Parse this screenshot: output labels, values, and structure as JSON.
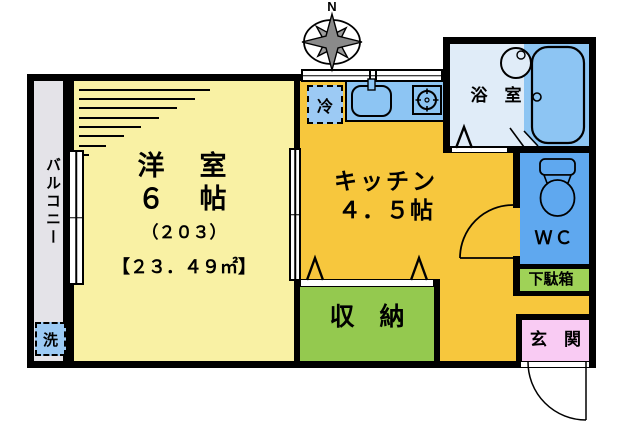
{
  "compass": {
    "north_label": "N"
  },
  "rooms": {
    "balcony": {
      "label": "バルコニー"
    },
    "living": {
      "name": "洋　室",
      "size": "６　帖",
      "unit_no": "（２０３）",
      "area": "【２３．４９㎡】"
    },
    "kitchen": {
      "name": "キッチン",
      "size": "４．５帖"
    },
    "bath": {
      "label": "浴　室"
    },
    "wc": {
      "label": "ＷＣ"
    },
    "shoe_cabinet": {
      "label": "下駄箱"
    },
    "entrance": {
      "label": "玄　関"
    },
    "storage": {
      "label": "収　納"
    },
    "refrigerator": {
      "label": "冷"
    },
    "washer": {
      "label": "洗"
    }
  },
  "colors": {
    "wall": "#000000",
    "living_room": "#f9f1a4",
    "kitchen": "#f7c73d",
    "balcony": "#e4e3e8",
    "bath_floor": "#e0ecf8",
    "bath_wet_zone": "#8dc5f3",
    "wc": "#5fa8ef",
    "storage": "#94c94f",
    "shoe_cabinet": "#9fd257",
    "entrance": "#f9cbf3",
    "appliance_box": "#9ccaf4"
  }
}
